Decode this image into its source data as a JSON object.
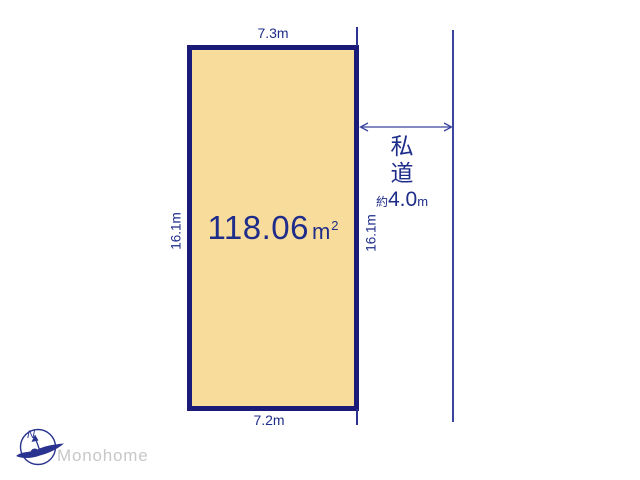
{
  "plot": {
    "area_value": "118.06",
    "area_unit": "m",
    "area_unit_sup": "2",
    "dim_top": "7.3m",
    "dim_bottom": "7.2m",
    "dim_left": "16.1m",
    "dim_right": "16.1m"
  },
  "road": {
    "label_char1": "私",
    "label_char2": "道",
    "width_prefix": "約",
    "width_value": "4.0",
    "width_unit": "m"
  },
  "branding": {
    "company_name": "Monohome",
    "compass_icon": "compass-north-icon",
    "compass_n": "N"
  },
  "colors": {
    "plot_fill": "#f8dc9c",
    "plot_border": "#1a1a78",
    "dimension_text": "#1f2d8a",
    "line": "#39459e",
    "logo_text": "#c8c8c8"
  }
}
